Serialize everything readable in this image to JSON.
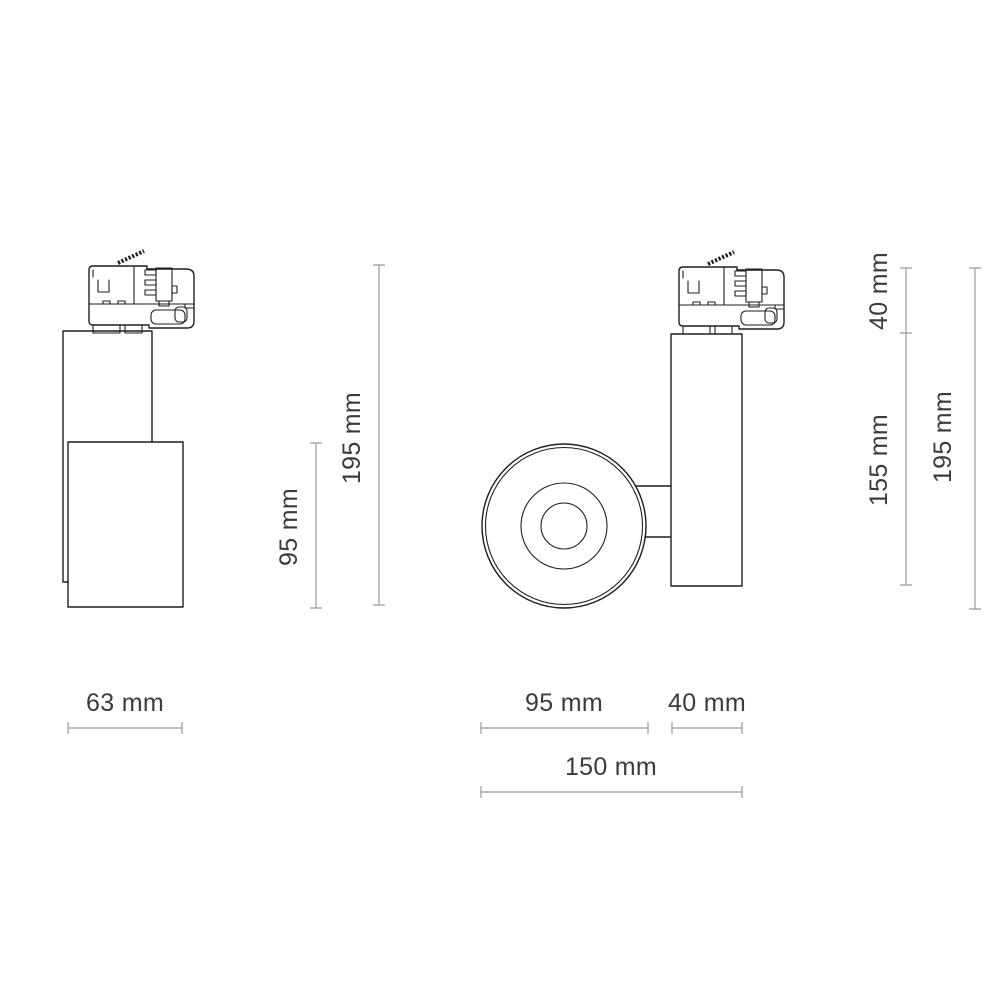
{
  "colors": {
    "background": "#ffffff",
    "drawing_outline": "#1f1f1f",
    "dimension_line": "#9b9b9b",
    "label_text": "#3b3b3b"
  },
  "views": {
    "side": {
      "name": "side view of track spotlight",
      "labels": {
        "base_width": "63 mm",
        "head_height": "95 mm",
        "total_height": "195 mm"
      }
    },
    "front": {
      "name": "front view of track spotlight",
      "labels": {
        "head_diameter": "95 mm",
        "body_depth": "40 mm",
        "total_depth": "150 mm",
        "adapter_height": "40 mm",
        "body_height": "155 mm",
        "total_height": "195 mm"
      }
    }
  }
}
